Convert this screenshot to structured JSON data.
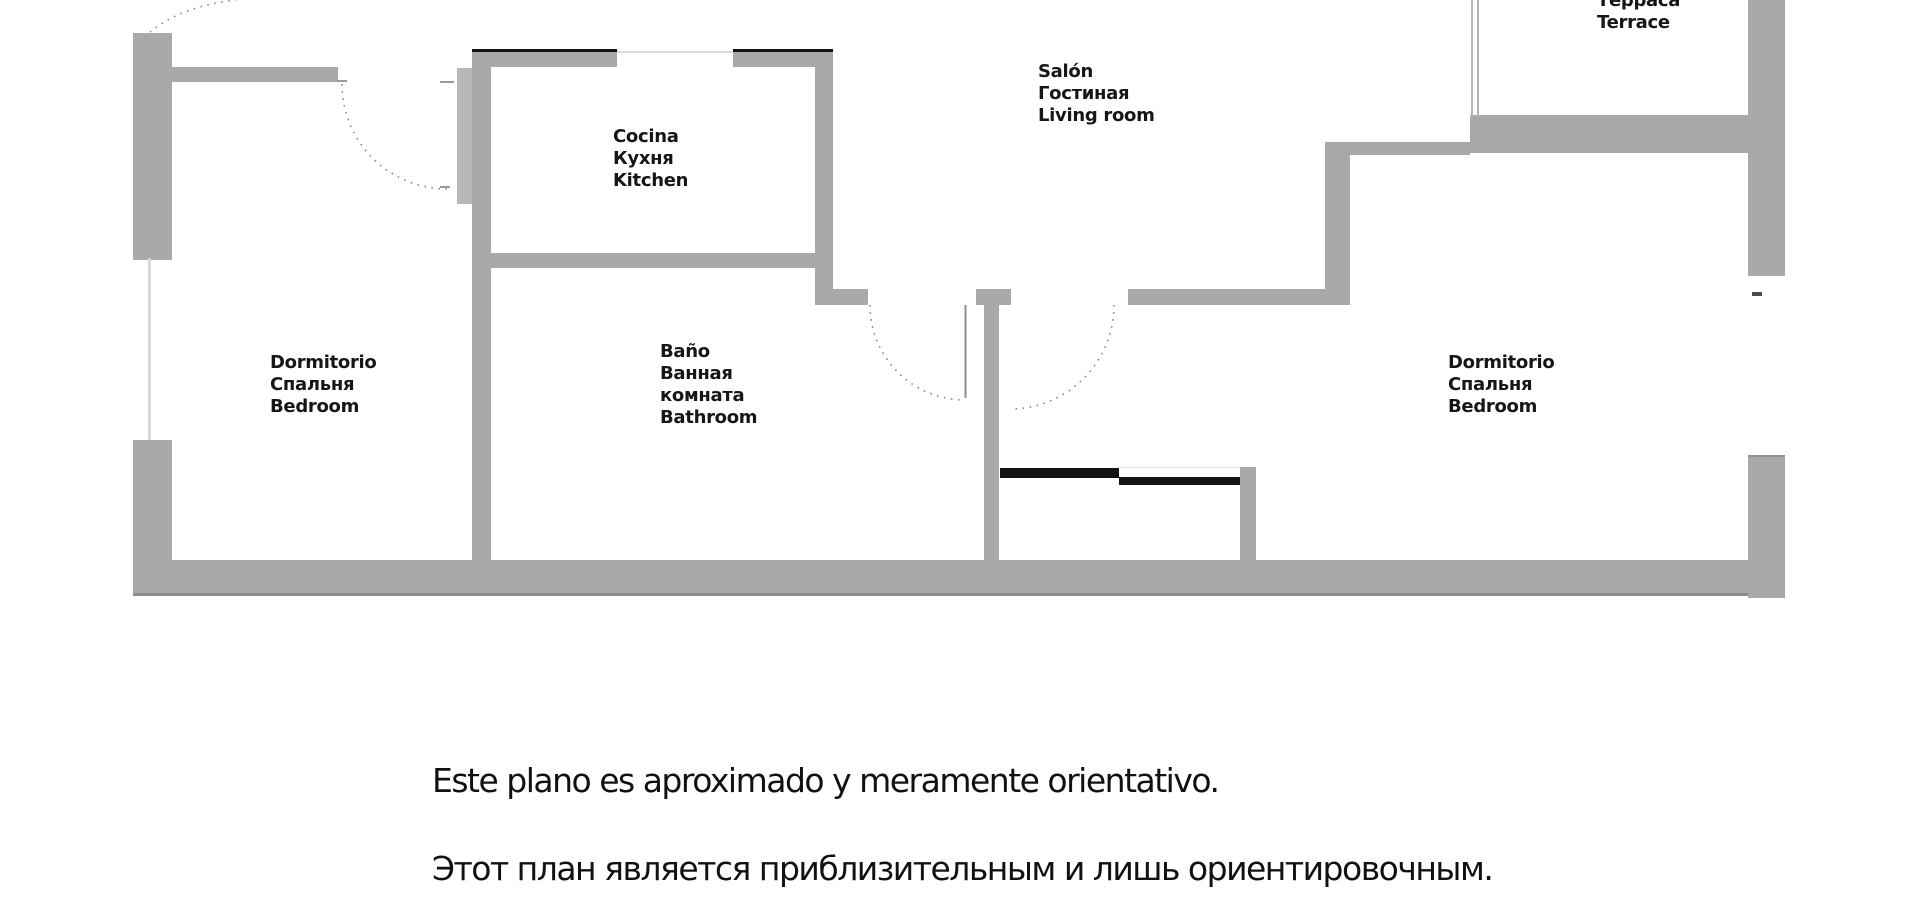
{
  "floor_plan": {
    "rooms": {
      "bedroom_left": {
        "lines": [
          "Dormitorio",
          "Спальня",
          "Bedroom"
        ]
      },
      "kitchen": {
        "lines": [
          "Cocina",
          "Кухня",
          "Kitchen"
        ]
      },
      "living_room": {
        "lines": [
          "Salón",
          "Гостиная",
          "Living room"
        ]
      },
      "bathroom": {
        "lines": [
          "Baño",
          "Ванная",
          "комната",
          "Bathroom"
        ]
      },
      "bedroom_right": {
        "lines": [
          "Dormitorio",
          "Спальня",
          "Bedroom"
        ]
      },
      "terrace": {
        "lines": [
          "Терраса",
          "Terrace"
        ]
      }
    },
    "colors": {
      "wall": "#a9a9a9",
      "wall_edge": "#8c8c8c",
      "sliding_door": "#141414",
      "label_text": "#161616"
    }
  },
  "disclaimer": {
    "spanish": "Este plano es aproximado y meramente orientativo.",
    "russian": "Этот план является приблизительным и лишь ориентировочным."
  }
}
